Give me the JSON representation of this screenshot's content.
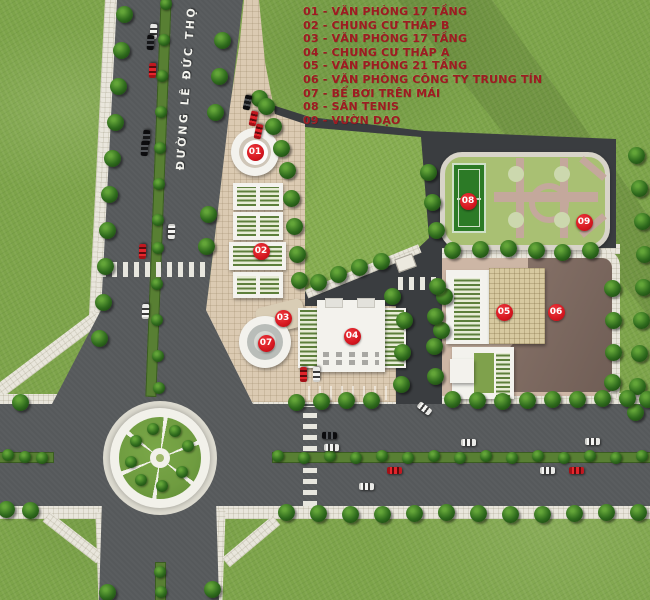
{
  "legend": {
    "items": [
      "01 - VĂN PHÒNG 17 TẦNG",
      "02 - CHUNG CƯ THÁP B",
      "03 - VĂN PHÒNG 17 TẦNG",
      "04 - CHUNG CƯ THÁP A",
      "05 - VĂN PHÒNG 21 TẦNG",
      "06 - VĂN PHÒNG CÔNG TY TRUNG TÍN",
      "07 - BỂ BƠI TRÊN MÁI",
      "08 - SÂN TENIS",
      "09 - VƯỜN DẠO"
    ]
  },
  "road_label": "ĐƯỜNG LÊ ĐỨC THỌ",
  "markers": [
    {
      "id": "01",
      "x": 255,
      "y": 152,
      "ring": true
    },
    {
      "id": "02",
      "x": 261,
      "y": 251,
      "ring": false
    },
    {
      "id": "03",
      "x": 283,
      "y": 318,
      "ring": false
    },
    {
      "id": "04",
      "x": 352,
      "y": 336,
      "ring": false
    },
    {
      "id": "05",
      "x": 504,
      "y": 312,
      "ring": false
    },
    {
      "id": "06",
      "x": 556,
      "y": 312,
      "ring": false
    },
    {
      "id": "07",
      "x": 266,
      "y": 343,
      "ring": false
    },
    {
      "id": "08",
      "x": 468,
      "y": 201,
      "ring": false
    },
    {
      "id": "09",
      "x": 584,
      "y": 222,
      "ring": false
    }
  ],
  "colors": {
    "grass": "#7da44a",
    "road": "#56595b",
    "complex_asphalt": "#3a3d40",
    "sidewalk": "#e9e6dc",
    "plaza": "#dbcab2",
    "marker_red": "#d5161f",
    "legend_text": "#9f1b21",
    "tennis_court": "#2c7a26",
    "pavement_06": "#8b756b",
    "median_green": "#587f33"
  },
  "map": {
    "trees": {
      "large": [
        [
          124,
          14
        ],
        [
          121,
          50
        ],
        [
          118,
          86
        ],
        [
          115,
          122
        ],
        [
          112,
          158
        ],
        [
          109,
          194
        ],
        [
          107,
          230
        ],
        [
          105,
          266
        ],
        [
          103,
          302
        ],
        [
          99,
          338
        ],
        [
          20,
          402
        ],
        [
          222,
          40
        ],
        [
          219,
          76
        ],
        [
          215,
          112
        ],
        [
          208,
          214
        ],
        [
          206,
          246
        ],
        [
          259,
          98
        ],
        [
          266,
          106
        ],
        [
          273,
          126
        ],
        [
          281,
          148
        ],
        [
          287,
          170
        ],
        [
          291,
          198
        ],
        [
          294,
          226
        ],
        [
          297,
          254
        ],
        [
          299,
          280
        ],
        [
          318,
          282
        ],
        [
          338,
          274
        ],
        [
          359,
          267
        ],
        [
          381,
          261
        ],
        [
          392,
          296
        ],
        [
          404,
          320
        ],
        [
          402,
          352
        ],
        [
          401,
          384
        ],
        [
          444,
          296
        ],
        [
          441,
          330
        ],
        [
          428,
          172
        ],
        [
          432,
          202
        ],
        [
          436,
          230
        ],
        [
          452,
          250
        ],
        [
          480,
          249
        ],
        [
          508,
          248
        ],
        [
          536,
          250
        ],
        [
          562,
          252
        ],
        [
          590,
          250
        ],
        [
          437,
          286
        ],
        [
          435,
          316
        ],
        [
          434,
          346
        ],
        [
          435,
          376
        ],
        [
          612,
          288
        ],
        [
          613,
          320
        ],
        [
          613,
          352
        ],
        [
          612,
          382
        ],
        [
          636,
          155
        ],
        [
          639,
          188
        ],
        [
          642,
          221
        ],
        [
          644,
          254
        ],
        [
          643,
          287
        ],
        [
          641,
          320
        ],
        [
          639,
          353
        ],
        [
          637,
          386
        ],
        [
          635,
          412
        ],
        [
          296,
          402
        ],
        [
          321,
          401
        ],
        [
          346,
          400
        ],
        [
          371,
          400
        ],
        [
          452,
          399
        ],
        [
          477,
          400
        ],
        [
          502,
          401
        ],
        [
          527,
          400
        ],
        [
          552,
          399
        ],
        [
          577,
          399
        ],
        [
          602,
          398
        ],
        [
          627,
          398
        ],
        [
          647,
          399
        ],
        [
          286,
          512
        ],
        [
          318,
          513
        ],
        [
          350,
          514
        ],
        [
          382,
          514
        ],
        [
          414,
          513
        ],
        [
          446,
          512
        ],
        [
          478,
          513
        ],
        [
          510,
          514
        ],
        [
          542,
          514
        ],
        [
          574,
          513
        ],
        [
          606,
          512
        ],
        [
          638,
          512
        ],
        [
          6,
          509
        ],
        [
          30,
          510
        ],
        [
          107,
          592
        ],
        [
          212,
          589
        ]
      ],
      "small": [
        [
          166,
          4
        ],
        [
          164,
          40
        ],
        [
          162,
          76
        ],
        [
          161,
          112
        ],
        [
          160,
          148
        ],
        [
          159,
          184
        ],
        [
          158,
          220
        ],
        [
          158,
          248
        ],
        [
          157,
          284
        ],
        [
          157,
          320
        ],
        [
          158,
          356
        ],
        [
          159,
          388
        ],
        [
          278,
          456
        ],
        [
          304,
          458
        ],
        [
          330,
          456
        ],
        [
          356,
          458
        ],
        [
          382,
          456
        ],
        [
          408,
          458
        ],
        [
          434,
          456
        ],
        [
          460,
          458
        ],
        [
          486,
          456
        ],
        [
          512,
          458
        ],
        [
          538,
          456
        ],
        [
          564,
          458
        ],
        [
          590,
          456
        ],
        [
          616,
          458
        ],
        [
          642,
          456
        ],
        [
          8,
          455
        ],
        [
          25,
          457
        ],
        [
          42,
          458
        ],
        [
          160,
          572
        ],
        [
          161,
          592
        ],
        [
          188,
          446
        ],
        [
          175,
          431
        ],
        [
          153,
          429
        ],
        [
          136,
          441
        ],
        [
          131,
          462
        ],
        [
          141,
          480
        ],
        [
          162,
          486
        ],
        [
          182,
          472
        ]
      ]
    },
    "cars": [
      [
        153,
        31,
        -87,
        "w"
      ],
      [
        150,
        42,
        -87,
        "b"
      ],
      [
        152,
        70,
        -88,
        "r"
      ],
      [
        146,
        137,
        -87,
        "b"
      ],
      [
        144,
        148,
        -87,
        "b"
      ],
      [
        142,
        251,
        -88,
        "r"
      ],
      [
        171,
        231,
        92,
        "w"
      ],
      [
        145,
        311,
        -88,
        "w"
      ],
      [
        247,
        102,
        -78,
        "b"
      ],
      [
        253,
        118,
        -78,
        "r"
      ],
      [
        258,
        131,
        -78,
        "r"
      ],
      [
        329,
        435,
        1,
        "b"
      ],
      [
        331,
        447,
        1,
        "w"
      ],
      [
        468,
        442,
        0,
        "w"
      ],
      [
        592,
        441,
        0,
        "w"
      ],
      [
        424,
        408,
        38,
        "w"
      ],
      [
        394,
        470,
        0,
        "r"
      ],
      [
        366,
        486,
        1,
        "w"
      ],
      [
        547,
        470,
        0,
        "w"
      ],
      [
        576,
        470,
        0,
        "r"
      ],
      [
        303,
        374,
        -90,
        "r"
      ],
      [
        316,
        374,
        -90,
        "w"
      ]
    ]
  }
}
